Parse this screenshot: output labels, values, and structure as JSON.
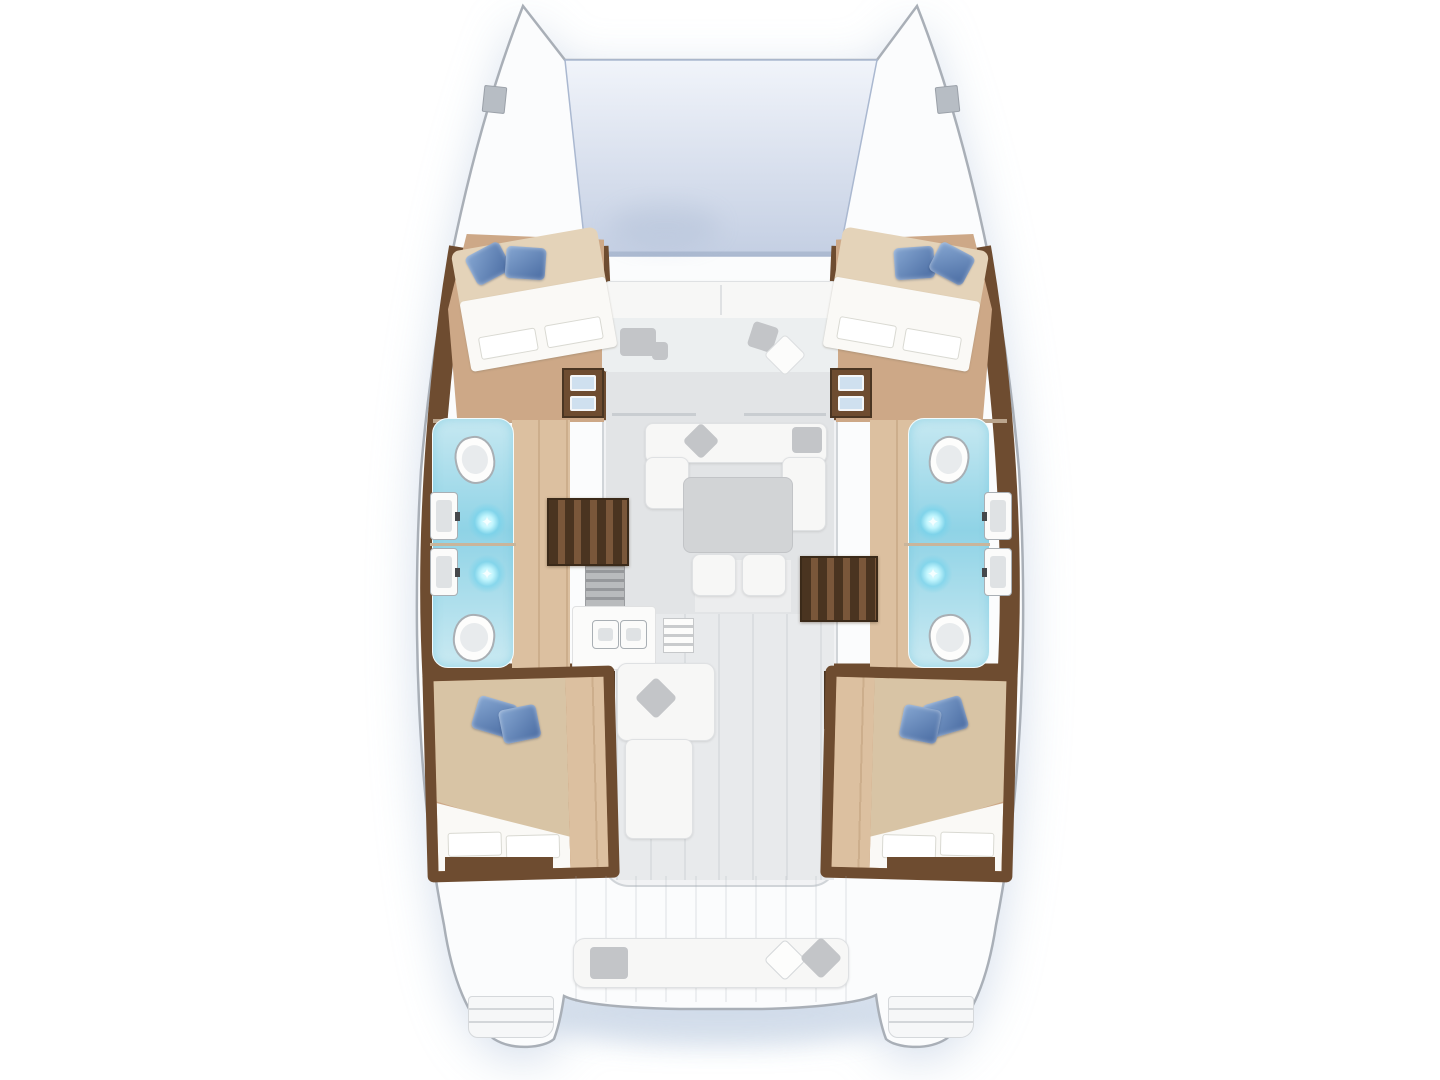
{
  "scene": {
    "subject": "Catamaran yacht floor plan, top-down deck view",
    "inventory": {
      "hulls": 2,
      "cabins_with_double_beds": 4,
      "bathrooms": 4,
      "toilets": 4,
      "sinks": 4,
      "showers": 4,
      "hull_staircases": 2,
      "step_drawer_units": 4,
      "saloon_sofa": 1,
      "saloon_table": 1,
      "galley_sinks": 2,
      "forward_trampoline": 1,
      "forward_cockpit_bench": 1,
      "aft_cockpit_bench": 1,
      "transom_step_platforms": 2,
      "bow_deck_hatches": 2
    },
    "icons": {
      "shower_sparkle_glyph": "✦"
    }
  },
  "palette": {
    "bg": "#ffffff",
    "water-shadow": "#c9d6e6",
    "hull-fill": "#fbfcfd",
    "hull-stroke": "#a9afb7",
    "tramp-top": "#f1f4fa",
    "tramp-bottom": "#c4cfe3",
    "tramp-edge": "#aab8d0",
    "wood-dark": "#6e4c30",
    "wood-floor": "#cda887",
    "wood-floor-light": "#dcc0a0",
    "stair-dark": "#4a3420",
    "stair-light": "#7a573a",
    "bed-blanket": "#d8c4a5",
    "bed-head-tan": "#e4d3b9",
    "sheet-white": "#faf9f6",
    "pillow-blue": "#80a1cd",
    "pillow-blue-dark": "#4c6ea4",
    "bath-blue-top": "#c6e8f1",
    "bath-blue-mid": "#8fd3e6",
    "bath-deep": "#5fc0dc",
    "fixture-stroke": "#a9afb4",
    "saloon-floor": "#e2e4e6",
    "walkway-floor": "#e8eaec",
    "sofa-white": "#f7f7f6",
    "cushion-gray": "#c3c5c8",
    "table-gray": "#d2d4d6",
    "appliance-gray": "#b9bbbd",
    "drawer-blue": "#cfe0ef",
    "line-gray": "#c9cdd1",
    "deck-line": "#d0d4d8"
  }
}
